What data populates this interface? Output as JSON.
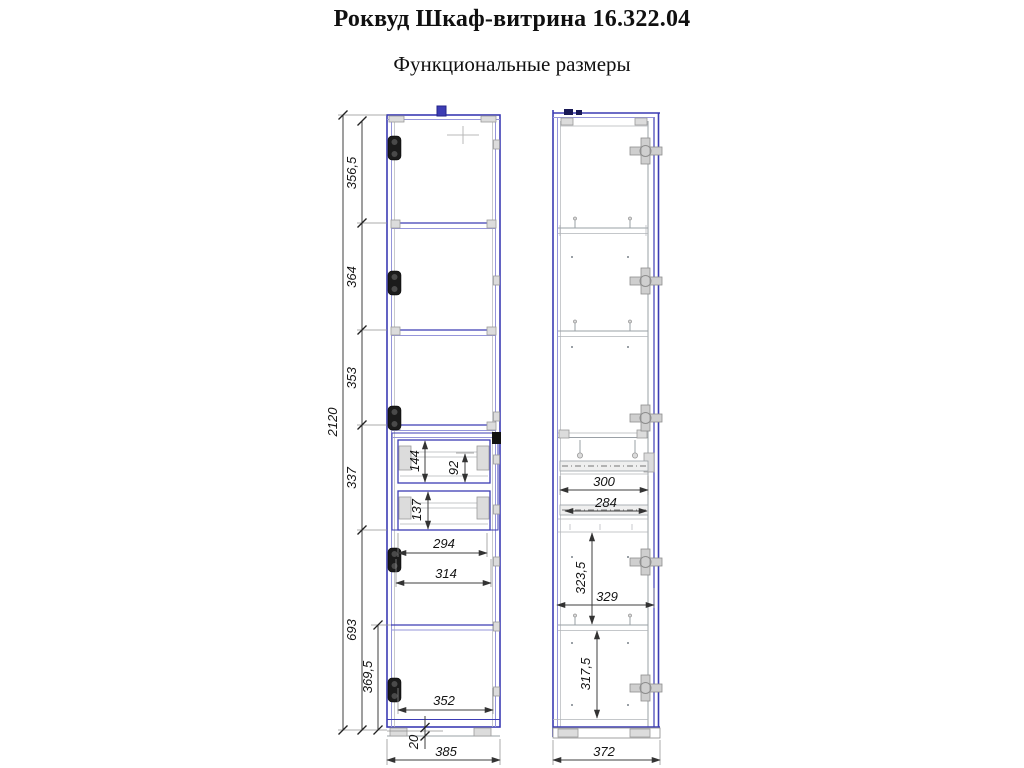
{
  "page": {
    "title": "Роквуд Шкаф-витрина 16.322.04",
    "subtitle": "Функциональные размеры"
  },
  "colors": {
    "outline_blue": "#3c3cb4",
    "detail_gray": "#9aa0a6",
    "dimension_line": "#3f3f3f"
  },
  "front_view": {
    "dims": {
      "total_height": "2120",
      "top_section": "356,5",
      "second_section": "364",
      "third_section": "353",
      "drawer_section": "337",
      "bottom_section": "693",
      "bottom_inner_height": "369,5",
      "upper_drawer_height": "144",
      "upper_drawer_inner_height": "92",
      "lower_drawer_height": "137",
      "drawer_inner_width": "294",
      "drawer_opening_width": "314",
      "bottom_inner_width": "352",
      "plinth_height": "20",
      "overall_width": "385"
    }
  },
  "side_view": {
    "dims": {
      "slide_length": "300",
      "slide_inner_length": "284",
      "upper_compartment_height": "323,5",
      "inner_depth": "329",
      "lower_compartment_height": "317,5",
      "overall_depth": "372"
    }
  }
}
